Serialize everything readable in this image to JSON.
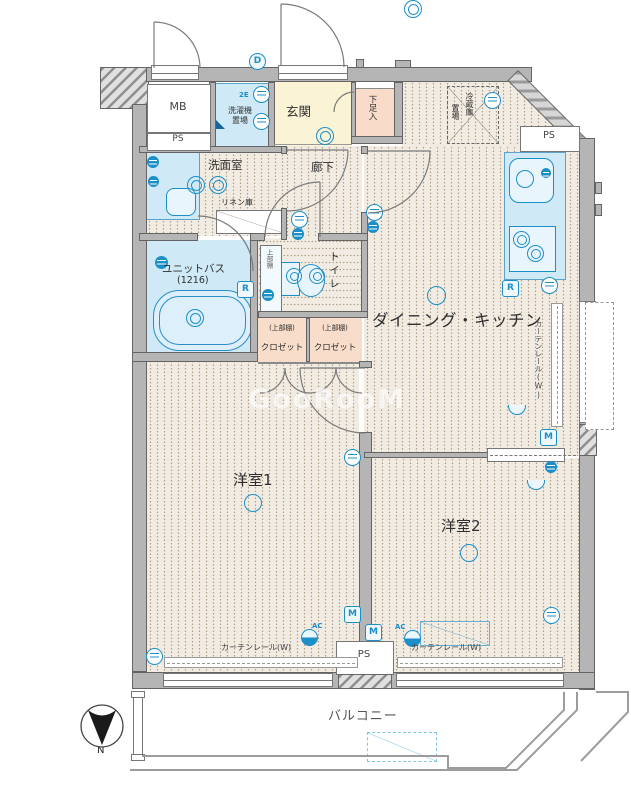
{
  "labels": {
    "mb": "MB",
    "ps": "PS",
    "washer1": "洗濯機",
    "washer2": "置場",
    "genkan": "玄関",
    "shoe": "下足入",
    "fridge1": "冷蔵庫",
    "fridge2": "置場",
    "washroom": "洗面室",
    "linen": "リネン庫",
    "corridor": "廊下",
    "bath": "ユニットバス",
    "bath_size": "(1216)",
    "toilet": "トイレ",
    "upper_shelf": "上部棚",
    "closet_shelf": "(上部棚)",
    "closet": "クロゼット",
    "dk": "ダイニング・キッチン",
    "curtain": "カーテンレール(W)",
    "room1": "洋室1",
    "room2": "洋室2",
    "balcony": "バルコニー",
    "north": "N"
  },
  "badges": {
    "d": "D",
    "e2": "2E",
    "r": "R",
    "m": "M",
    "ac": "AC"
  },
  "colors": {
    "accent": "#1d8fc8",
    "wall": "#b5b5b5",
    "floor": "#f1ebe2",
    "genkan": "#faf3d6",
    "closet": "#f8ddcb",
    "fixture": "#cfe9f6"
  },
  "watermark": "GooRooM"
}
